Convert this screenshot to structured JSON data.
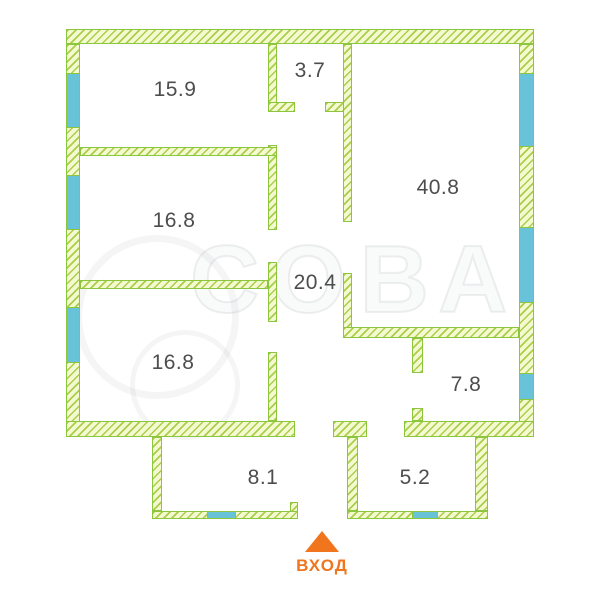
{
  "plan": {
    "canvas": {
      "width": 600,
      "height": 600,
      "background": "#ffffff"
    },
    "colors": {
      "wall_fill": "#F4F9D0",
      "wall_hatch": "#A9CE4B",
      "wall_border": "#8CC63E",
      "window_fill": "#69C3D8",
      "label": "#4D4D4D",
      "entrance": "#F0751D"
    },
    "walls": [
      {
        "x": 66,
        "y": 29,
        "w": 468,
        "h": 15
      },
      {
        "x": 66,
        "y": 44,
        "w": 14,
        "h": 393
      },
      {
        "x": 519,
        "y": 44,
        "w": 15,
        "h": 393
      },
      {
        "x": 66,
        "y": 421,
        "w": 229,
        "h": 16
      },
      {
        "x": 333,
        "y": 421,
        "w": 34,
        "h": 16
      },
      {
        "x": 404,
        "y": 421,
        "w": 130,
        "h": 16
      },
      {
        "x": 268,
        "y": 44,
        "w": 9,
        "h": 68
      },
      {
        "x": 268,
        "y": 102,
        "w": 27,
        "h": 10
      },
      {
        "x": 325,
        "y": 102,
        "w": 27,
        "h": 10
      },
      {
        "x": 268,
        "y": 145,
        "w": 9,
        "h": 85
      },
      {
        "x": 80,
        "y": 147,
        "w": 197,
        "h": 9
      },
      {
        "x": 268,
        "y": 262,
        "w": 9,
        "h": 60
      },
      {
        "x": 80,
        "y": 280,
        "w": 188,
        "h": 9
      },
      {
        "x": 268,
        "y": 352,
        "w": 9,
        "h": 69
      },
      {
        "x": 343,
        "y": 44,
        "w": 9,
        "h": 178
      },
      {
        "x": 343,
        "y": 273,
        "w": 9,
        "h": 65
      },
      {
        "x": 343,
        "y": 327,
        "w": 176,
        "h": 11
      },
      {
        "x": 412,
        "y": 338,
        "w": 11,
        "h": 35
      },
      {
        "x": 412,
        "y": 408,
        "w": 11,
        "h": 13
      },
      {
        "x": 347,
        "y": 437,
        "w": 11,
        "h": 74
      },
      {
        "x": 152,
        "y": 437,
        "w": 10,
        "h": 74
      },
      {
        "x": 152,
        "y": 511,
        "w": 146,
        "h": 8
      },
      {
        "x": 290,
        "y": 502,
        "w": 8,
        "h": 10
      },
      {
        "x": 347,
        "y": 511,
        "w": 141,
        "h": 8
      },
      {
        "x": 475,
        "y": 437,
        "w": 13,
        "h": 74
      }
    ],
    "windows": [
      {
        "x": 66,
        "y": 73,
        "w": 14,
        "h": 55
      },
      {
        "x": 66,
        "y": 175,
        "w": 14,
        "h": 55
      },
      {
        "x": 66,
        "y": 307,
        "w": 14,
        "h": 56
      },
      {
        "x": 519,
        "y": 73,
        "w": 15,
        "h": 74
      },
      {
        "x": 519,
        "y": 227,
        "w": 15,
        "h": 76
      },
      {
        "x": 519,
        "y": 373,
        "w": 15,
        "h": 27
      },
      {
        "x": 207,
        "y": 511,
        "w": 29,
        "h": 8
      },
      {
        "x": 412,
        "y": 511,
        "w": 26,
        "h": 8
      }
    ],
    "rooms": [
      {
        "area": "15.9",
        "cx": 175,
        "cy": 90
      },
      {
        "area": "3.7",
        "cx": 310,
        "cy": 71
      },
      {
        "area": "40.8",
        "cx": 438,
        "cy": 188
      },
      {
        "area": "16.8",
        "cx": 174,
        "cy": 221
      },
      {
        "area": "20.4",
        "cx": 315,
        "cy": 283
      },
      {
        "area": "16.8",
        "cx": 173,
        "cy": 363
      },
      {
        "area": "7.8",
        "cx": 466,
        "cy": 385
      },
      {
        "area": "8.1",
        "cx": 263,
        "cy": 478
      },
      {
        "area": "5.2",
        "cx": 415,
        "cy": 478
      }
    ],
    "entrance": {
      "label": "ВХОД",
      "cx": 322,
      "arrow_top_y": 531,
      "label_y": 556
    },
    "watermark": {
      "text": "СОВА"
    }
  }
}
